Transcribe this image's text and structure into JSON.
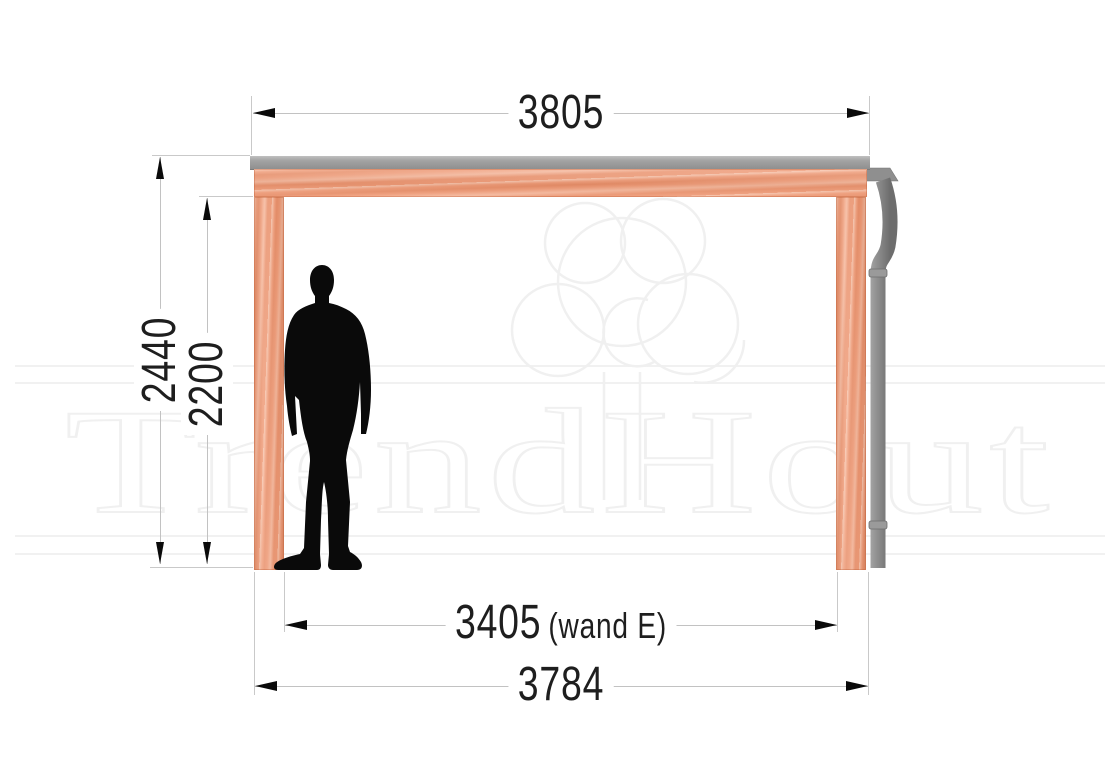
{
  "watermark": {
    "brand": "TrendHout"
  },
  "drawing": {
    "type": "veranda-side-elevation",
    "dimensions": {
      "top_width": {
        "value": "3805"
      },
      "outer_height": {
        "value": "2440"
      },
      "inner_height": {
        "value": "2200"
      },
      "inner_width": {
        "value": "3405",
        "suffix": "(wand E)"
      },
      "bottom_width": {
        "value": "3784"
      }
    },
    "colors": {
      "wood": "#f09a76",
      "roof_edge": "#9a9a9a",
      "gutter": "#8c8c8c",
      "silhouette": "#0a0a0a",
      "dimension_line": "#c4c4c4",
      "dimension_text": "#1e1e1e",
      "arrow": "#0a0a0a",
      "watermark": "#f1f1f1"
    }
  }
}
